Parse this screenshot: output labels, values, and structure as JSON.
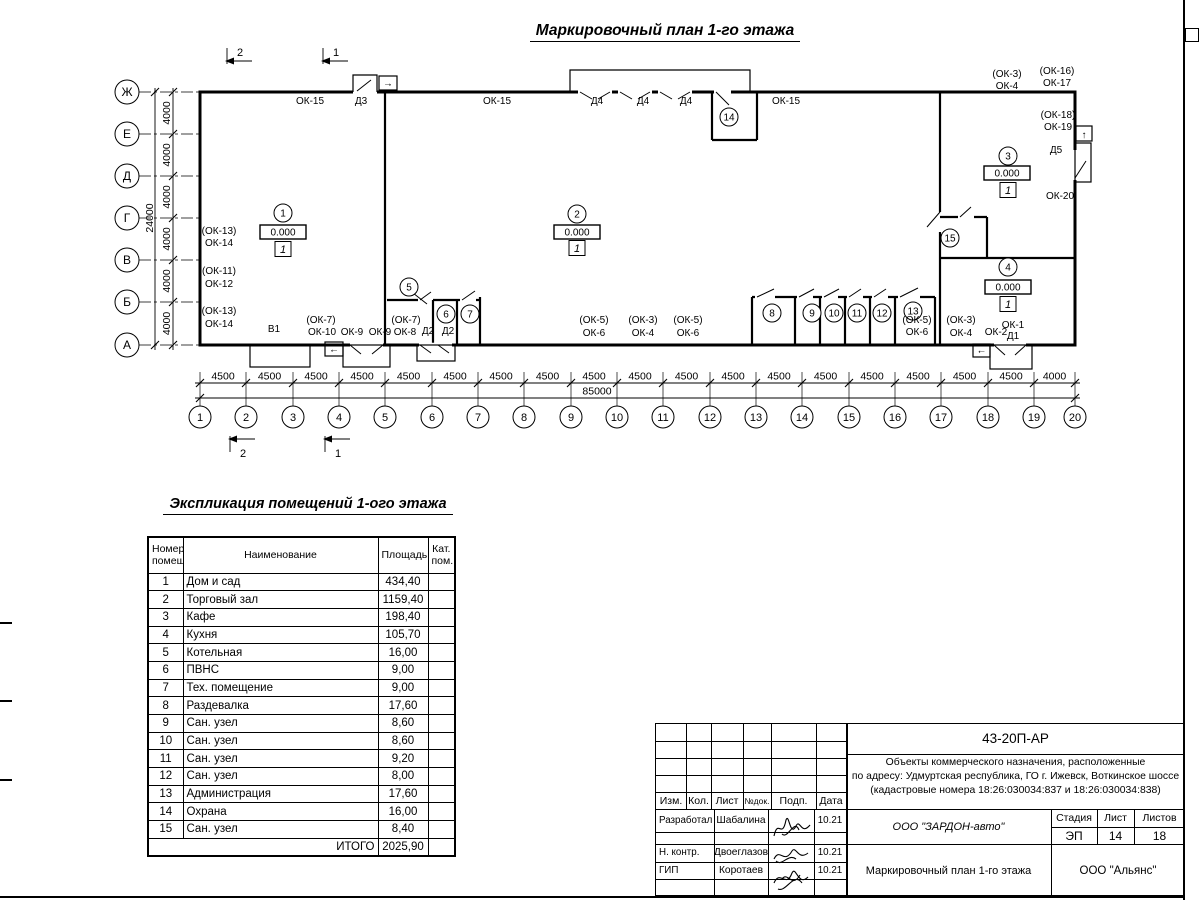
{
  "sheet": {
    "plan_title": "Маркировочный план 1-го этажа",
    "explication_title": "Экспликация помещений 1-ого этажа"
  },
  "plan": {
    "axis_letters": [
      "Ж",
      "Е",
      "Д",
      "Г",
      "В",
      "Б",
      "А"
    ],
    "axis_numbers": [
      "1",
      "2",
      "3",
      "4",
      "5",
      "6",
      "7",
      "8",
      "9",
      "10",
      "11",
      "12",
      "13",
      "14",
      "15",
      "16",
      "17",
      "18",
      "19",
      "20"
    ],
    "rooms": [
      "1",
      "2",
      "3",
      "4",
      "5",
      "6",
      "7",
      "8",
      "9",
      "10",
      "11",
      "12",
      "13",
      "14",
      "15"
    ],
    "labels": [
      "ОК-15",
      "Д3",
      "ОК-15",
      "Д4",
      "Д4",
      "Д4",
      "ОК-15",
      "(ОК-3)",
      "ОК-4",
      "(ОК-16)",
      "ОК-17",
      "(ОК-18)",
      "ОК-19",
      "Д5",
      "ОК-20",
      "(ОК-13)",
      "ОК-14",
      "(ОК-11)",
      "ОК-12",
      "(ОК-13)",
      "ОК-14",
      "В1",
      "(ОК-7)",
      "ОК-10",
      "ОК-9",
      "ОК-9",
      "(ОК-7)",
      "ОК-8",
      "Д2",
      "Д2",
      "(ОК-5)",
      "ОК-6",
      "(ОК-3)",
      "ОК-4",
      "(ОК-5)",
      "ОК-6",
      "(ОК-5)",
      "ОК-6",
      "(ОК-3)",
      "ОК-4",
      "ОК-1",
      "ОК-2",
      "Д1"
    ],
    "h_dims": [
      "4500",
      "4500",
      "4500",
      "4500",
      "4500",
      "4500",
      "4500",
      "4500",
      "4500",
      "4500",
      "4500",
      "4500",
      "4500",
      "4500",
      "4500",
      "4500",
      "4500",
      "4500",
      "4000"
    ],
    "h_total": "85000",
    "v_dims": [
      "4000",
      "4000",
      "4000",
      "4000",
      "4000",
      "4000"
    ],
    "v_total": "24000",
    "elevation": "0.000",
    "level": "1",
    "section_1": "1",
    "section_2": "2",
    "arrows": {
      "right": "→",
      "left": "←",
      "up": "↑"
    }
  },
  "explication": {
    "headers": [
      "Номер помещ.",
      "Наименование",
      "Площадь",
      "Кат. пом."
    ],
    "rows": [
      [
        "1",
        "Дом и сад",
        "434,40",
        ""
      ],
      [
        "2",
        "Торговый зал",
        "1159,40",
        ""
      ],
      [
        "3",
        "Кафе",
        "198,40",
        ""
      ],
      [
        "4",
        "Кухня",
        "105,70",
        ""
      ],
      [
        "5",
        "Котельная",
        "16,00",
        ""
      ],
      [
        "6",
        "ПВНС",
        "9,00",
        ""
      ],
      [
        "7",
        "Тех. помещение",
        "9,00",
        ""
      ],
      [
        "8",
        "Раздевалка",
        "17,60",
        ""
      ],
      [
        "9",
        "Сан. узел",
        "8,60",
        ""
      ],
      [
        "10",
        "Сан. узел",
        "8,60",
        ""
      ],
      [
        "11",
        "Сан. узел",
        "9,20",
        ""
      ],
      [
        "12",
        "Сан. узел",
        "8,00",
        ""
      ],
      [
        "13",
        "Администрация",
        "17,60",
        ""
      ],
      [
        "14",
        "Охрана",
        "16,00",
        ""
      ],
      [
        "15",
        "Сан. узел",
        "8,40",
        ""
      ]
    ],
    "total_label": "ИТОГО",
    "total_value": "2025,90"
  },
  "titleblock": {
    "doc_number": "43-20П-АР",
    "description_lines": [
      "Объекты коммерческого назначения, расположенные",
      "по адресу: Удмуртская республика, ГО г. Ижевск, Воткинское шоссе",
      "(кадастровые номера 18:26:030034:837 и 18:26:030034:838)"
    ],
    "columns": [
      "Изм.",
      "Кол.",
      "Лист",
      "№док.",
      "Подп.",
      "Дата"
    ],
    "signers": [
      {
        "role": "Разработал",
        "name": "Шабалина",
        "date": "10.21"
      },
      {
        "role": "Н. контр.",
        "name": "Двоеглазов",
        "date": "10.21"
      },
      {
        "role": "ГИП",
        "name": "Коротаев",
        "date": "10.21"
      }
    ],
    "stage_label": "Стадия",
    "sheet_label": "Лист",
    "sheets_label": "Листов",
    "stage": "ЭП",
    "sheet_num": "14",
    "sheets_total": "18",
    "company": "ООО \"ЗАРДОН-авто\"",
    "drawing_title": "Маркировочный план 1-го этажа",
    "firm": "ООО \"Альянс\""
  }
}
